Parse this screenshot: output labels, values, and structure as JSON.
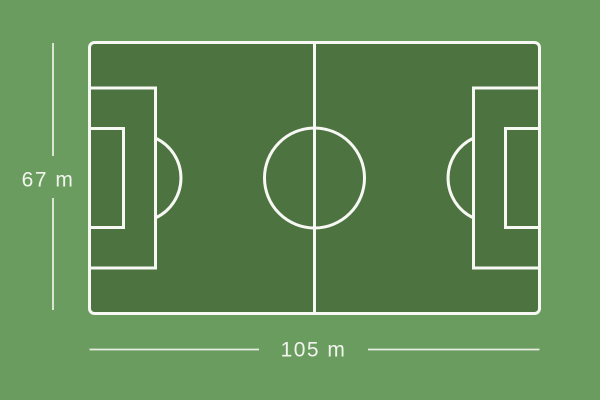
{
  "diagram": {
    "type": "football-pitch-dimensions",
    "labels": {
      "pitch_height": "67 m",
      "pitch_width": "105 m"
    },
    "measurements": {
      "height_m": 67,
      "width_m": 105,
      "unit": "m"
    },
    "colors": {
      "background": "#699c5e",
      "pitch": "#4c7340",
      "line": "#f7f8f3",
      "dimension": "#e6ecdf",
      "dimtext": "#f2f5ee"
    }
  }
}
